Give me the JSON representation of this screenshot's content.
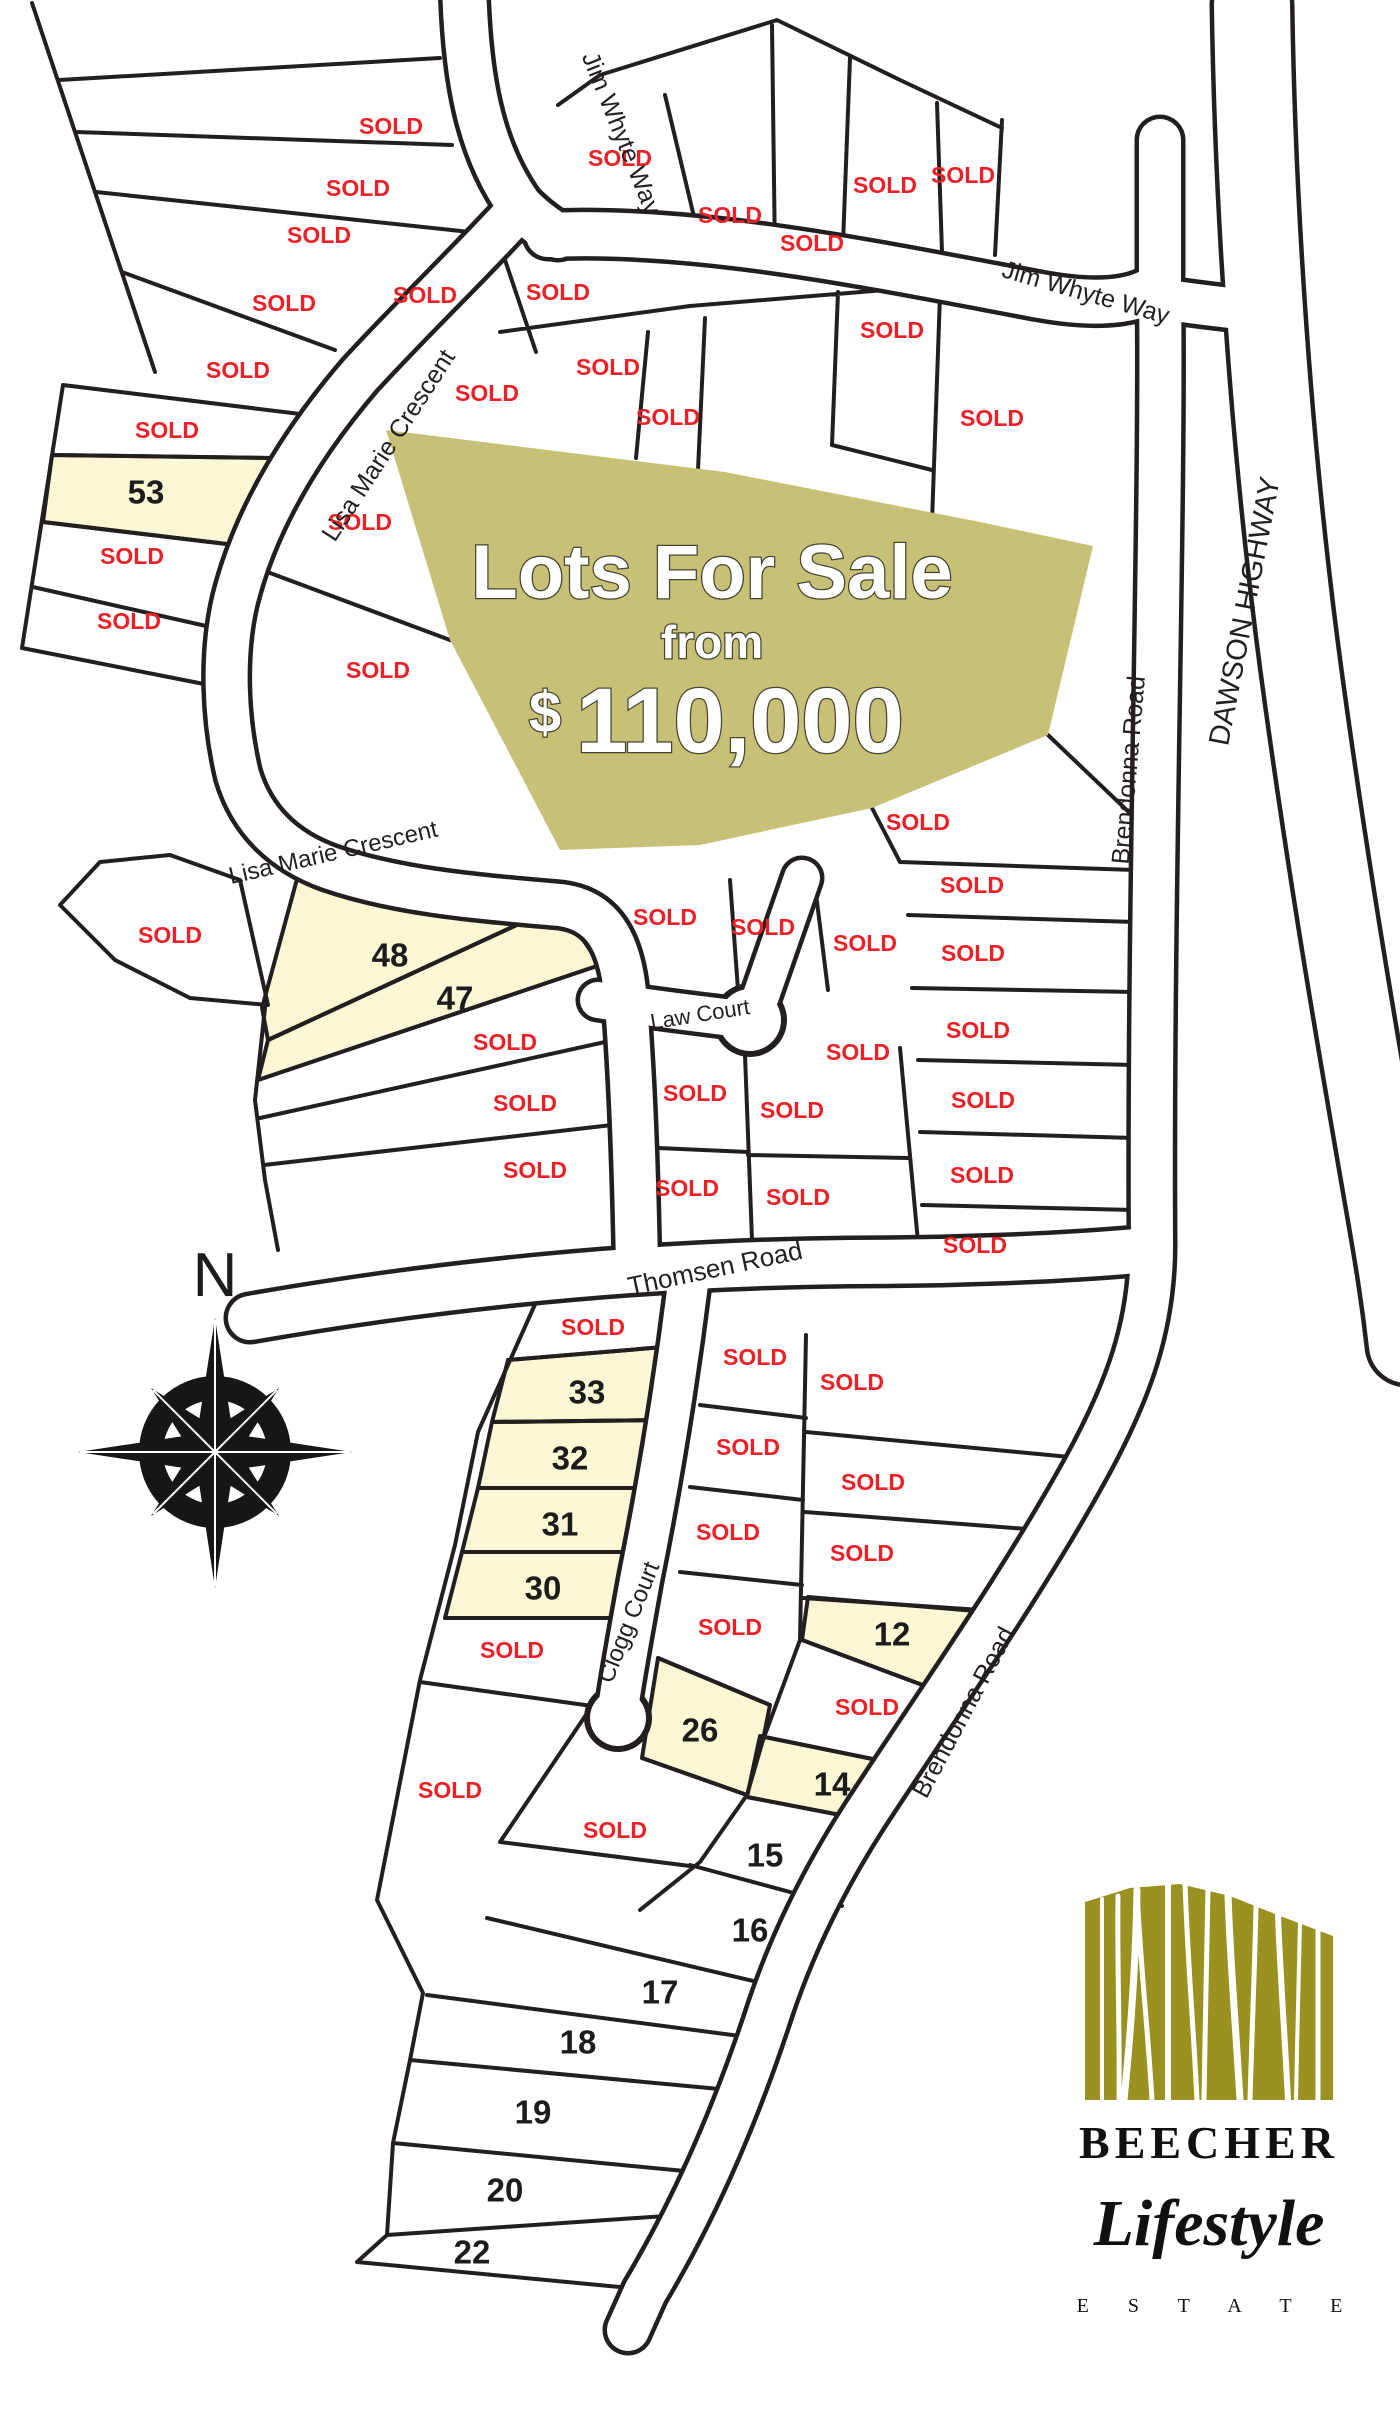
{
  "map": {
    "sold_label": "SOLD",
    "banner": {
      "line1": "Lots For Sale",
      "line2": "from",
      "price_symbol": "$",
      "price_amount": "110,000"
    },
    "compass_label": "N",
    "colors": {
      "sold_red": "#EC2027",
      "available_yellow": "#FAF8D4",
      "banner_olive": "#C7C178",
      "logo_olive": "#9A9120",
      "line_black": "#231F20"
    },
    "road_labels": [
      {
        "text": "Jim Whyte Way",
        "x": 622,
        "y": 133,
        "rot": 68,
        "size": 25
      },
      {
        "text": "Jim Whyte Way",
        "x": 1086,
        "y": 292,
        "rot": 16,
        "size": 25
      },
      {
        "text": "Lisa Marie Crescent",
        "x": 388,
        "y": 445,
        "rot": -57,
        "size": 25
      },
      {
        "text": "Lisa Marie Crescent",
        "x": 333,
        "y": 852,
        "rot": -13,
        "size": 24
      },
      {
        "text": "Law Court",
        "x": 700,
        "y": 1014,
        "rot": -9,
        "size": 22
      },
      {
        "text": "Thomsen Road",
        "x": 715,
        "y": 1268,
        "rot": -12,
        "size": 26
      },
      {
        "text": "Clogg Court",
        "x": 628,
        "y": 1622,
        "rot": -68,
        "size": 24
      },
      {
        "text": "Brendonna Road",
        "x": 1128,
        "y": 770,
        "rot": -85,
        "size": 25
      },
      {
        "text": "Brendonna Road",
        "x": 963,
        "y": 1712,
        "rot": -62,
        "size": 25
      },
      {
        "text": "DAWSON HIGHWAY",
        "x": 1244,
        "y": 611,
        "rot": -79,
        "size": 29
      }
    ],
    "sold_positions": [
      [
        391,
        126
      ],
      [
        358,
        188
      ],
      [
        319,
        235
      ],
      [
        284,
        303
      ],
      [
        238,
        370
      ],
      [
        167,
        430
      ],
      [
        132,
        556
      ],
      [
        129,
        621
      ],
      [
        360,
        522
      ],
      [
        378,
        670
      ],
      [
        620,
        158
      ],
      [
        730,
        215
      ],
      [
        812,
        243
      ],
      [
        885,
        185
      ],
      [
        963,
        175
      ],
      [
        425,
        295
      ],
      [
        558,
        292
      ],
      [
        608,
        367
      ],
      [
        487,
        393
      ],
      [
        668,
        417
      ],
      [
        892,
        330
      ],
      [
        992,
        418
      ],
      [
        170,
        935
      ],
      [
        505,
        1042
      ],
      [
        525,
        1103
      ],
      [
        535,
        1170
      ],
      [
        665,
        917
      ],
      [
        763,
        927
      ],
      [
        865,
        943
      ],
      [
        918,
        822
      ],
      [
        972,
        885
      ],
      [
        973,
        953
      ],
      [
        978,
        1030
      ],
      [
        983,
        1100
      ],
      [
        982,
        1175
      ],
      [
        975,
        1245
      ],
      [
        858,
        1052
      ],
      [
        695,
        1093
      ],
      [
        792,
        1110
      ],
      [
        687,
        1188
      ],
      [
        798,
        1197
      ],
      [
        593,
        1327
      ],
      [
        755,
        1357
      ],
      [
        852,
        1382
      ],
      [
        748,
        1447
      ],
      [
        873,
        1482
      ],
      [
        728,
        1532
      ],
      [
        862,
        1553
      ],
      [
        730,
        1627
      ],
      [
        867,
        1707
      ],
      [
        512,
        1650
      ],
      [
        615,
        1830
      ],
      [
        450,
        1790
      ]
    ],
    "lots_for_sale": [
      {
        "num": "53",
        "label_x": 146,
        "label_y": 492,
        "points": "52,455 272,458 235,545 43,522"
      },
      {
        "num": "48",
        "label_x": 390,
        "label_y": 955,
        "points": "300,868 560,905 268,1040 262,1008"
      },
      {
        "num": "47",
        "label_x": 455,
        "label_y": 998,
        "points": "560,905 600,965 258,1080 268,1040"
      },
      {
        "num": "33",
        "label_x": 587,
        "label_y": 1392,
        "points": "508,1360 688,1345 672,1420 492,1422"
      },
      {
        "num": "32",
        "label_x": 570,
        "label_y": 1458,
        "points": "492,1422 672,1420 655,1488 478,1488"
      },
      {
        "num": "31",
        "label_x": 560,
        "label_y": 1524,
        "points": "478,1488 655,1488 640,1552 462,1552"
      },
      {
        "num": "30",
        "label_x": 543,
        "label_y": 1588,
        "points": "462,1552 640,1552 622,1618 445,1618"
      },
      {
        "num": "26",
        "label_x": 700,
        "label_y": 1730,
        "points": "658,1658 770,1705 763,1740 747,1795 642,1758"
      },
      {
        "num": "12",
        "label_x": 892,
        "label_y": 1634,
        "points": "808,1597 1012,1614 968,1702 802,1640"
      },
      {
        "num": "14",
        "label_x": 832,
        "label_y": 1784,
        "points": "760,1736 907,1766 887,1824 747,1797"
      }
    ],
    "lots_numbered": [
      {
        "num": "15",
        "label_x": 765,
        "label_y": 1855
      },
      {
        "num": "16",
        "label_x": 750,
        "label_y": 1930
      },
      {
        "num": "17",
        "label_x": 660,
        "label_y": 1992
      },
      {
        "num": "18",
        "label_x": 578,
        "label_y": 2042
      },
      {
        "num": "19",
        "label_x": 533,
        "label_y": 2112
      },
      {
        "num": "20",
        "label_x": 505,
        "label_y": 2190
      },
      {
        "num": "22",
        "label_x": 472,
        "label_y": 2252
      }
    ]
  },
  "logo": {
    "brand": "BEECHER",
    "script": "Lifestyle",
    "subtitle": "E S T A T E"
  }
}
